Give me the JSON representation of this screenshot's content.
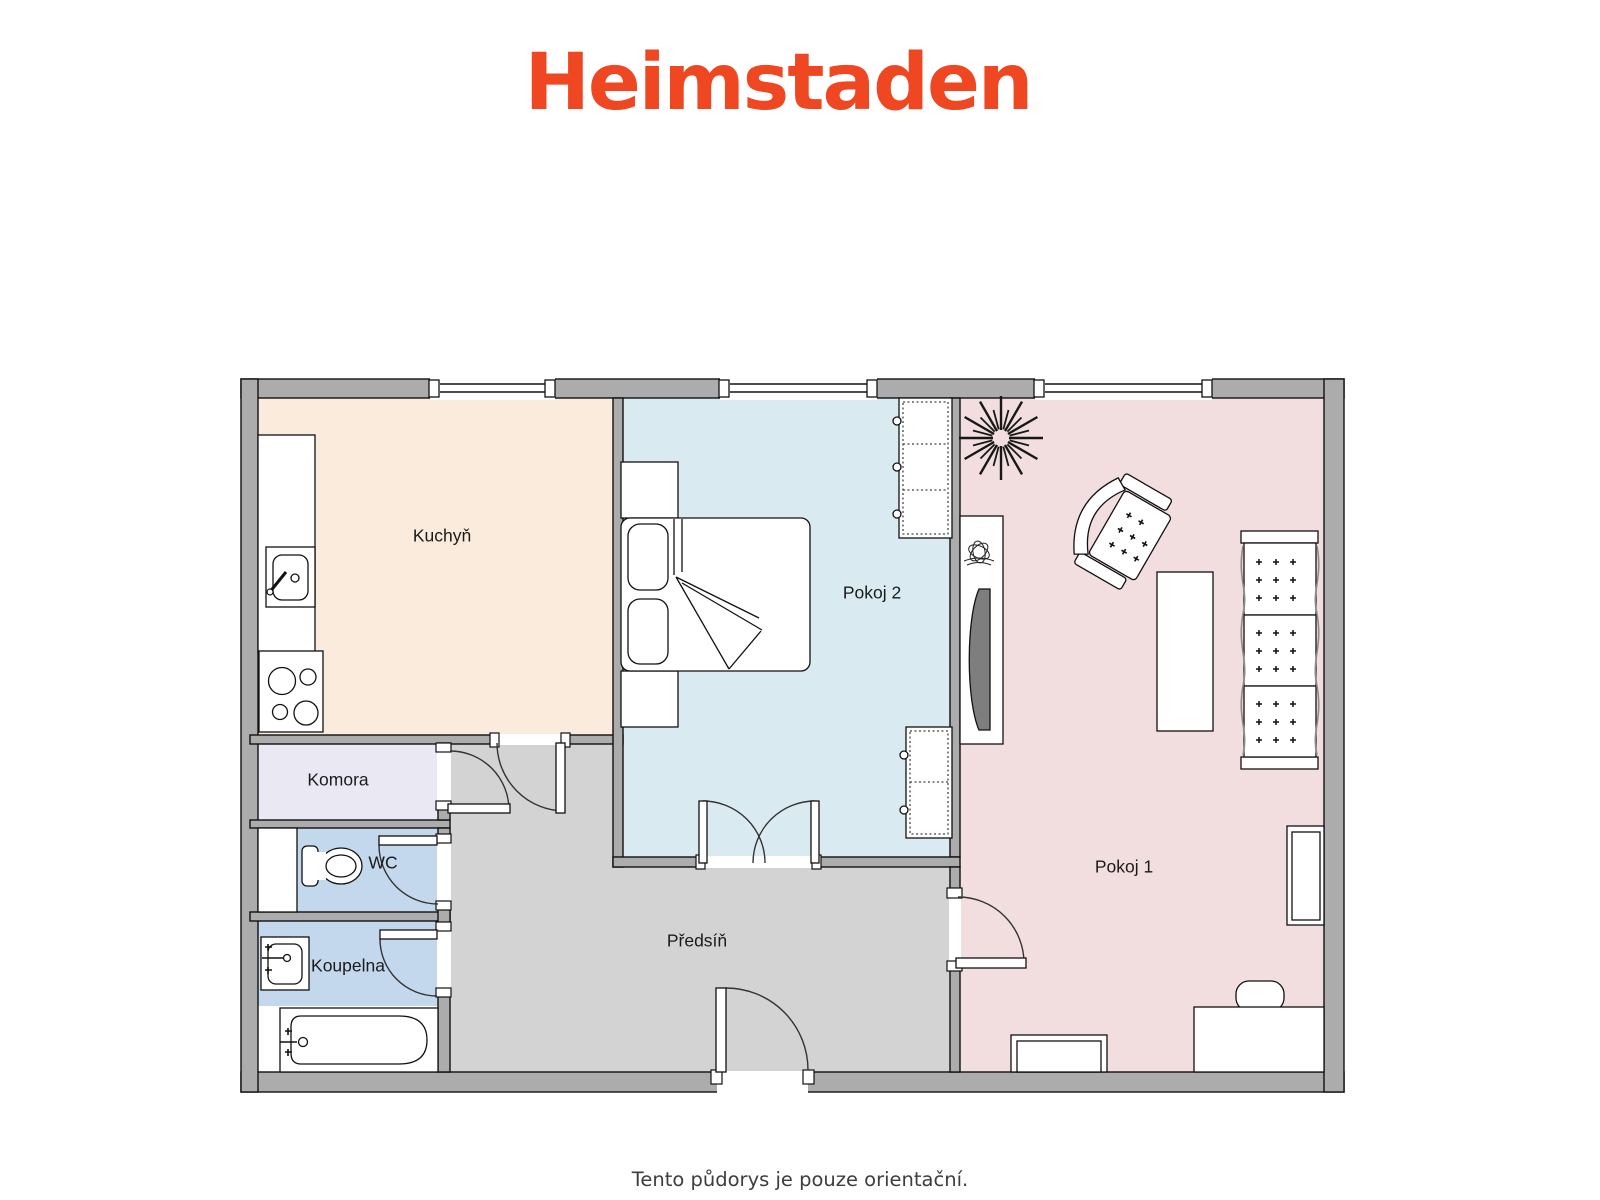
{
  "brand": {
    "name": "Heimstaden",
    "color": "#f04723"
  },
  "caption": "Tento půdorys je pouze orientační.",
  "rooms": {
    "kuchyn": {
      "label": "Kuchyň",
      "color": "#faebdc"
    },
    "pokoj2": {
      "label": "Pokoj 2",
      "color": "#daeaf1"
    },
    "pokoj1": {
      "label": "Pokoj 1",
      "color": "#f2dede"
    },
    "komora": {
      "label": "Komora",
      "color": "#eae8f2"
    },
    "wc": {
      "label": "WC",
      "color": "#c3d7ed"
    },
    "koupelna": {
      "label": "Koupelna",
      "color": "#c3d7ed"
    },
    "predsin": {
      "label": "Předsíň",
      "color": "#d3d3d3"
    }
  },
  "palette": {
    "wall": "#acacac",
    "outline": "#111111",
    "furniture_fill": "#ffffff",
    "tv_screen": "#7e7e7e",
    "label_text": "#1b1b1b",
    "caption_text": "#3d3d3d"
  }
}
